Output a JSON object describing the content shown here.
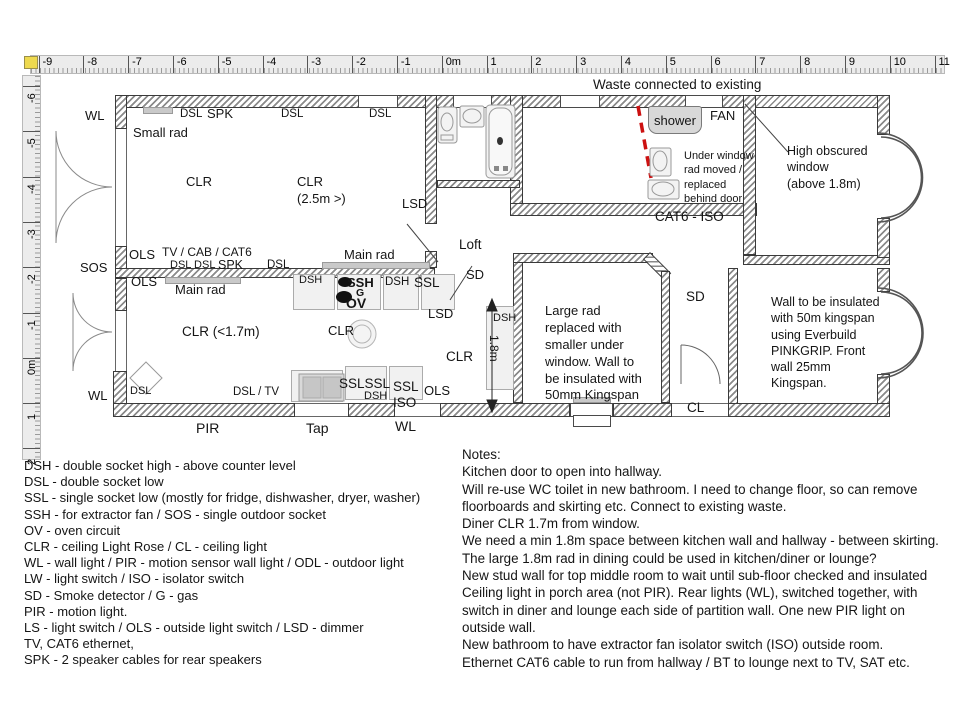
{
  "rulers": {
    "horizontal": {
      "ticks": [
        "-9",
        "-8",
        "-7",
        "-6",
        "-5",
        "-4",
        "-3",
        "-2",
        "-1",
        "0m",
        "1",
        "2",
        "3",
        "4",
        "5",
        "6",
        "7",
        "8",
        "9",
        "10",
        "11"
      ]
    },
    "vertical": {
      "ticks": [
        "-6",
        "-5",
        "-4",
        "-3",
        "-2",
        "-1",
        "0m",
        "1",
        "2"
      ]
    }
  },
  "plan": {
    "shower_label": "shower",
    "labels": [
      {
        "t": "Waste connected to existing",
        "x": 593,
        "y": 78,
        "fs": 13.5
      },
      {
        "t": "WL",
        "x": 85,
        "y": 109
      },
      {
        "t": "SOS",
        "x": 80,
        "y": 261
      },
      {
        "t": "WL",
        "x": 88,
        "y": 389
      },
      {
        "t": "PIR",
        "x": 196,
        "y": 421,
        "fs": 14
      },
      {
        "t": "Tap",
        "x": 306,
        "y": 421,
        "fs": 14
      },
      {
        "t": "WL",
        "x": 395,
        "y": 419,
        "fs": 14
      },
      {
        "t": "Small rad",
        "x": 133,
        "y": 126
      },
      {
        "t": "DSL",
        "x": 180,
        "y": 108,
        "fs": 11.5
      },
      {
        "t": "SPK",
        "x": 207,
        "y": 107,
        "fs": 13
      },
      {
        "t": "DSL",
        "x": 281,
        "y": 108,
        "fs": 11.5
      },
      {
        "t": "DSL",
        "x": 369,
        "y": 108,
        "fs": 11.5
      },
      {
        "t": "CLR",
        "x": 186,
        "y": 175
      },
      {
        "t": "CLR",
        "x": 297,
        "y": 175
      },
      {
        "t": "(2.5m >)",
        "x": 297,
        "y": 192
      },
      {
        "t": "TV / CAB / CAT6",
        "x": 162,
        "y": 246,
        "fs": 12
      },
      {
        "t": "DSL DSL",
        "x": 170,
        "y": 260,
        "fs": 11
      },
      {
        "t": "SPK",
        "x": 218,
        "y": 259,
        "fs": 12.5
      },
      {
        "t": "DSL",
        "x": 267,
        "y": 259,
        "fs": 11.5
      },
      {
        "t": "OLS",
        "x": 129,
        "y": 248
      },
      {
        "t": "OLS",
        "x": 131,
        "y": 275
      },
      {
        "t": "Main rad",
        "x": 175,
        "y": 283
      },
      {
        "t": "Main rad",
        "x": 344,
        "y": 248
      },
      {
        "t": "LSD",
        "x": 402,
        "y": 197
      },
      {
        "t": "Loft",
        "x": 459,
        "y": 238,
        "fs": 13.5
      },
      {
        "t": "SD",
        "x": 466,
        "y": 268
      },
      {
        "t": "LSD",
        "x": 428,
        "y": 307
      },
      {
        "t": "DSH",
        "x": 299,
        "y": 275,
        "fs": 11
      },
      {
        "t": "SSH",
        "x": 347,
        "y": 276,
        "fs": 13,
        "b": 1
      },
      {
        "t": "DSH",
        "x": 385,
        "y": 276,
        "fs": 11.5
      },
      {
        "t": "SSL",
        "x": 414,
        "y": 276,
        "fs": 13.5
      },
      {
        "t": "G",
        "x": 356,
        "y": 288,
        "fs": 10.5,
        "b": 1
      },
      {
        "t": "OV",
        "x": 346,
        "y": 296,
        "fs": 14,
        "b": 1
      },
      {
        "t": "CLR",
        "x": 328,
        "y": 324
      },
      {
        "t": "CLR",
        "x": 446,
        "y": 350,
        "fs": 13.5
      },
      {
        "t": "SSLSSL",
        "x": 339,
        "y": 377,
        "fs": 13.5
      },
      {
        "t": "DSH",
        "x": 364,
        "y": 391,
        "fs": 11
      },
      {
        "t": "SSL",
        "x": 393,
        "y": 380,
        "fs": 13.5
      },
      {
        "t": "ISO",
        "x": 393,
        "y": 396,
        "fs": 13.5
      },
      {
        "t": "OLS",
        "x": 424,
        "y": 384
      },
      {
        "t": "DSH",
        "x": 493,
        "y": 313,
        "fs": 11
      },
      {
        "t": "1.8m",
        "x": 500,
        "y": 335,
        "fs": 12,
        "rot": 1
      },
      {
        "t": "SD",
        "x": 686,
        "y": 290,
        "fs": 13.5
      },
      {
        "t": "CL",
        "x": 687,
        "y": 401,
        "fs": 13.5
      },
      {
        "t": "FAN",
        "x": 710,
        "y": 109,
        "fs": 13
      },
      {
        "t": "CAT6 - ISO",
        "x": 655,
        "y": 210,
        "fs": 13.5
      },
      {
        "t": "CLR (<1.7m)",
        "x": 182,
        "y": 325,
        "fs": 13.5
      },
      {
        "t": "DSL",
        "x": 130,
        "y": 386,
        "fs": 11
      },
      {
        "t": "DSL / TV",
        "x": 233,
        "y": 386,
        "fs": 11.5
      }
    ],
    "textblocks": [
      {
        "name": "under-window-rad-note",
        "x": 684,
        "y": 149,
        "fs": 11,
        "lines": [
          "Under window",
          "rad moved /",
          "replaced",
          "behind door"
        ]
      },
      {
        "name": "high-obscured-window-note",
        "x": 787,
        "y": 143,
        "fs": 12.5,
        "lines": [
          "High obscured",
          "window",
          "(above 1.8m)"
        ]
      },
      {
        "name": "dining-insulation-note",
        "x": 545,
        "y": 303,
        "fs": 13,
        "lines": [
          "Large rad",
          "replaced with",
          "smaller under",
          "window. Wall to",
          "be insulated with",
          "50mm Kingspan"
        ]
      },
      {
        "name": "lounge-insulation-note",
        "x": 771,
        "y": 294,
        "fs": 12.5,
        "lines": [
          "Wall to be insulated",
          "with 50m kingspan",
          "using Everbuild",
          "PINKGRIP. Front",
          "wall 25mm",
          "Kingspan."
        ]
      }
    ]
  },
  "legend": {
    "lines": [
      "DSH - double socket high - above counter level",
      "DSL - double socket low",
      "SSL - single socket low (mostly for fridge, dishwasher, dryer, washer)",
      "SSH - for extractor fan  /  SOS - single outdoor socket",
      "OV - oven circuit",
      "CLR - ceiling Light Rose / CL - ceiling light",
      "WL - wall light  / PIR - motion sensor wall light  /  ODL - outdoor light",
      "LW - light switch  /  ISO - isolator switch",
      "SD - Smoke detector / G - gas",
      "PIR - motion light.",
      "LS - light switch / OLS - outside light switch / LSD - dimmer",
      "TV, CAT6 ethernet,",
      "SPK - 2 speaker cables for rear speakers"
    ]
  },
  "notes": {
    "lines": [
      "Notes:",
      "Kitchen door to open into hallway.",
      "Will re-use WC toilet in new bathroom. I need to change floor, so can remove",
      "floorboards and skirting etc. Connect to existing waste.",
      "Diner CLR 1.7m from window.",
      "We need a min 1.8m space between kitchen wall and hallway - between skirting.",
      "The large 1.8m rad in dining could be used in kitchen/diner or lounge?",
      "New stud wall for top middle room to wait until sub-floor checked and insulated",
      "Ceiling light in porch area (not PIR). Rear lights (WL), switched together, with",
      "switch in diner and lounge each side of partition wall. One new PIR light on",
      "outside wall.",
      "New bathroom to have extractor fan isolator switch (ISO) outside room.",
      "Ethernet CAT6 cable to run from hallway / BT to lounge next to TV, SAT etc."
    ]
  },
  "colors": {
    "red_dashed": "#cc1111",
    "wall_line": "#3a3a3a",
    "shower_bg": "#d8d8d8",
    "ruler_bg": "#ececec"
  }
}
